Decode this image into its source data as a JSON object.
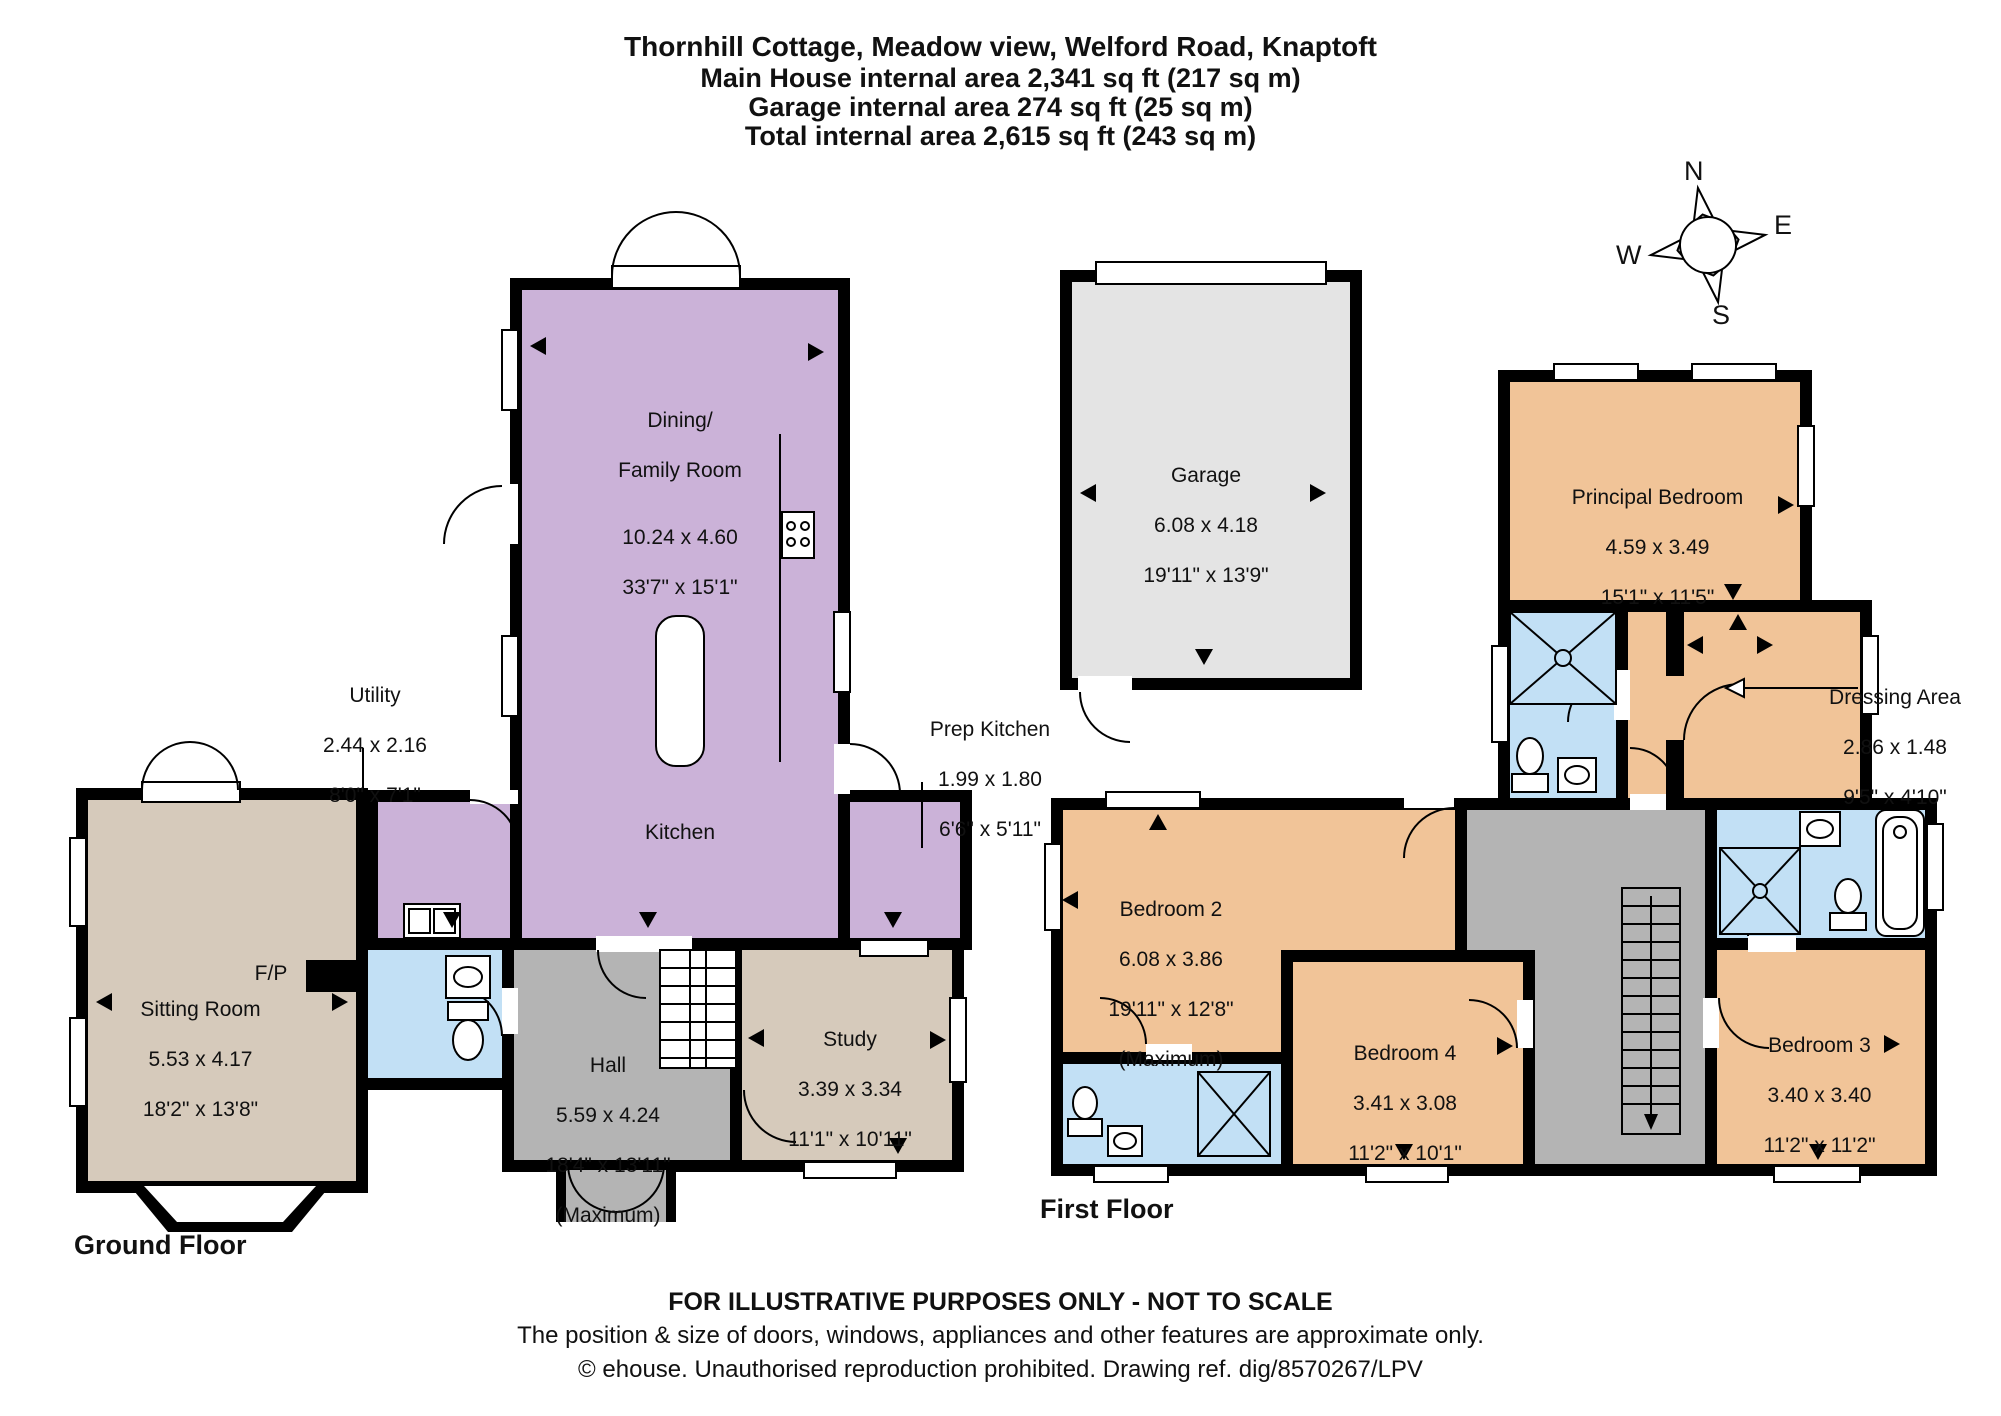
{
  "title": {
    "line1": "Thornhill Cottage, Meadow view, Welford Road, Knaptoft",
    "line2": "Main House internal area 2,341 sq ft (217 sq m)",
    "line3": "Garage internal area 274 sq ft (25 sq m)",
    "line4": "Total internal area 2,615 sq ft (243 sq m)"
  },
  "compass": {
    "n": "N",
    "e": "E",
    "s": "S",
    "w": "W"
  },
  "floors": {
    "ground": {
      "label": "Ground Floor"
    },
    "first": {
      "label": "First Floor"
    }
  },
  "rooms": {
    "dining": {
      "name1": "Dining/",
      "name2": "Family Room",
      "metric": "10.24 x 4.60",
      "imperial": "33'7\" x 15'1\""
    },
    "kitchen": {
      "name1": "Kitchen"
    },
    "utility": {
      "name1": "Utility",
      "metric": "2.44 x 2.16",
      "imperial": "8'0\" x 7'1\""
    },
    "prep": {
      "name1": "Prep Kitchen",
      "metric": "1.99 x 1.80",
      "imperial": "6'6\" x 5'11\""
    },
    "sitting": {
      "name1": "Sitting Room",
      "metric": "5.53 x 4.17",
      "imperial": "18'2\" x 13'8\""
    },
    "fireplace": {
      "name1": "F/P"
    },
    "hall": {
      "name1": "Hall",
      "metric": "5.59 x 4.24",
      "imperial": "18'4\" x 13'11\"",
      "note": "(Maximum)"
    },
    "study": {
      "name1": "Study",
      "metric": "3.39 x 3.34",
      "imperial": "11'1\" x 10'11\""
    },
    "garage": {
      "name1": "Garage",
      "metric": "6.08 x 4.18",
      "imperial": "19'11\" x 13'9\""
    },
    "principal": {
      "name1": "Principal Bedroom",
      "metric": "4.59 x 3.49",
      "imperial": "15'1\" x 11'5\""
    },
    "dressing": {
      "name1": "Dressing Area",
      "metric": "2.86 x 1.48",
      "imperial": "9'5\" x 4'10\""
    },
    "bedroom2": {
      "name1": "Bedroom 2",
      "metric": "6.08 x 3.86",
      "imperial": "19'11\" x 12'8\"",
      "note": "(Maximum)"
    },
    "bedroom3": {
      "name1": "Bedroom 3",
      "metric": "3.40 x 3.40",
      "imperial": "11'2\" x 11'2\""
    },
    "bedroom4": {
      "name1": "Bedroom 4",
      "metric": "3.41 x 3.08",
      "imperial": "11'2\" x 10'1\""
    }
  },
  "colors": {
    "kitchen_purple": "#cbb2d8",
    "living_beige": "#d6cabb",
    "hall_gray": "#b4b4b4",
    "bathroom_blue": "#c2e0f5",
    "bedroom_orange": "#f1c498",
    "garage_gray": "#e4e4e4",
    "wall_black": "#000000"
  },
  "footer": {
    "line1": "FOR ILLUSTRATIVE PURPOSES ONLY - NOT TO SCALE",
    "line2": "The position & size of doors, windows, appliances and other features are approximate only.",
    "line3": "© ehouse. Unauthorised reproduction prohibited. Drawing ref. dig/8570267/LPV"
  }
}
